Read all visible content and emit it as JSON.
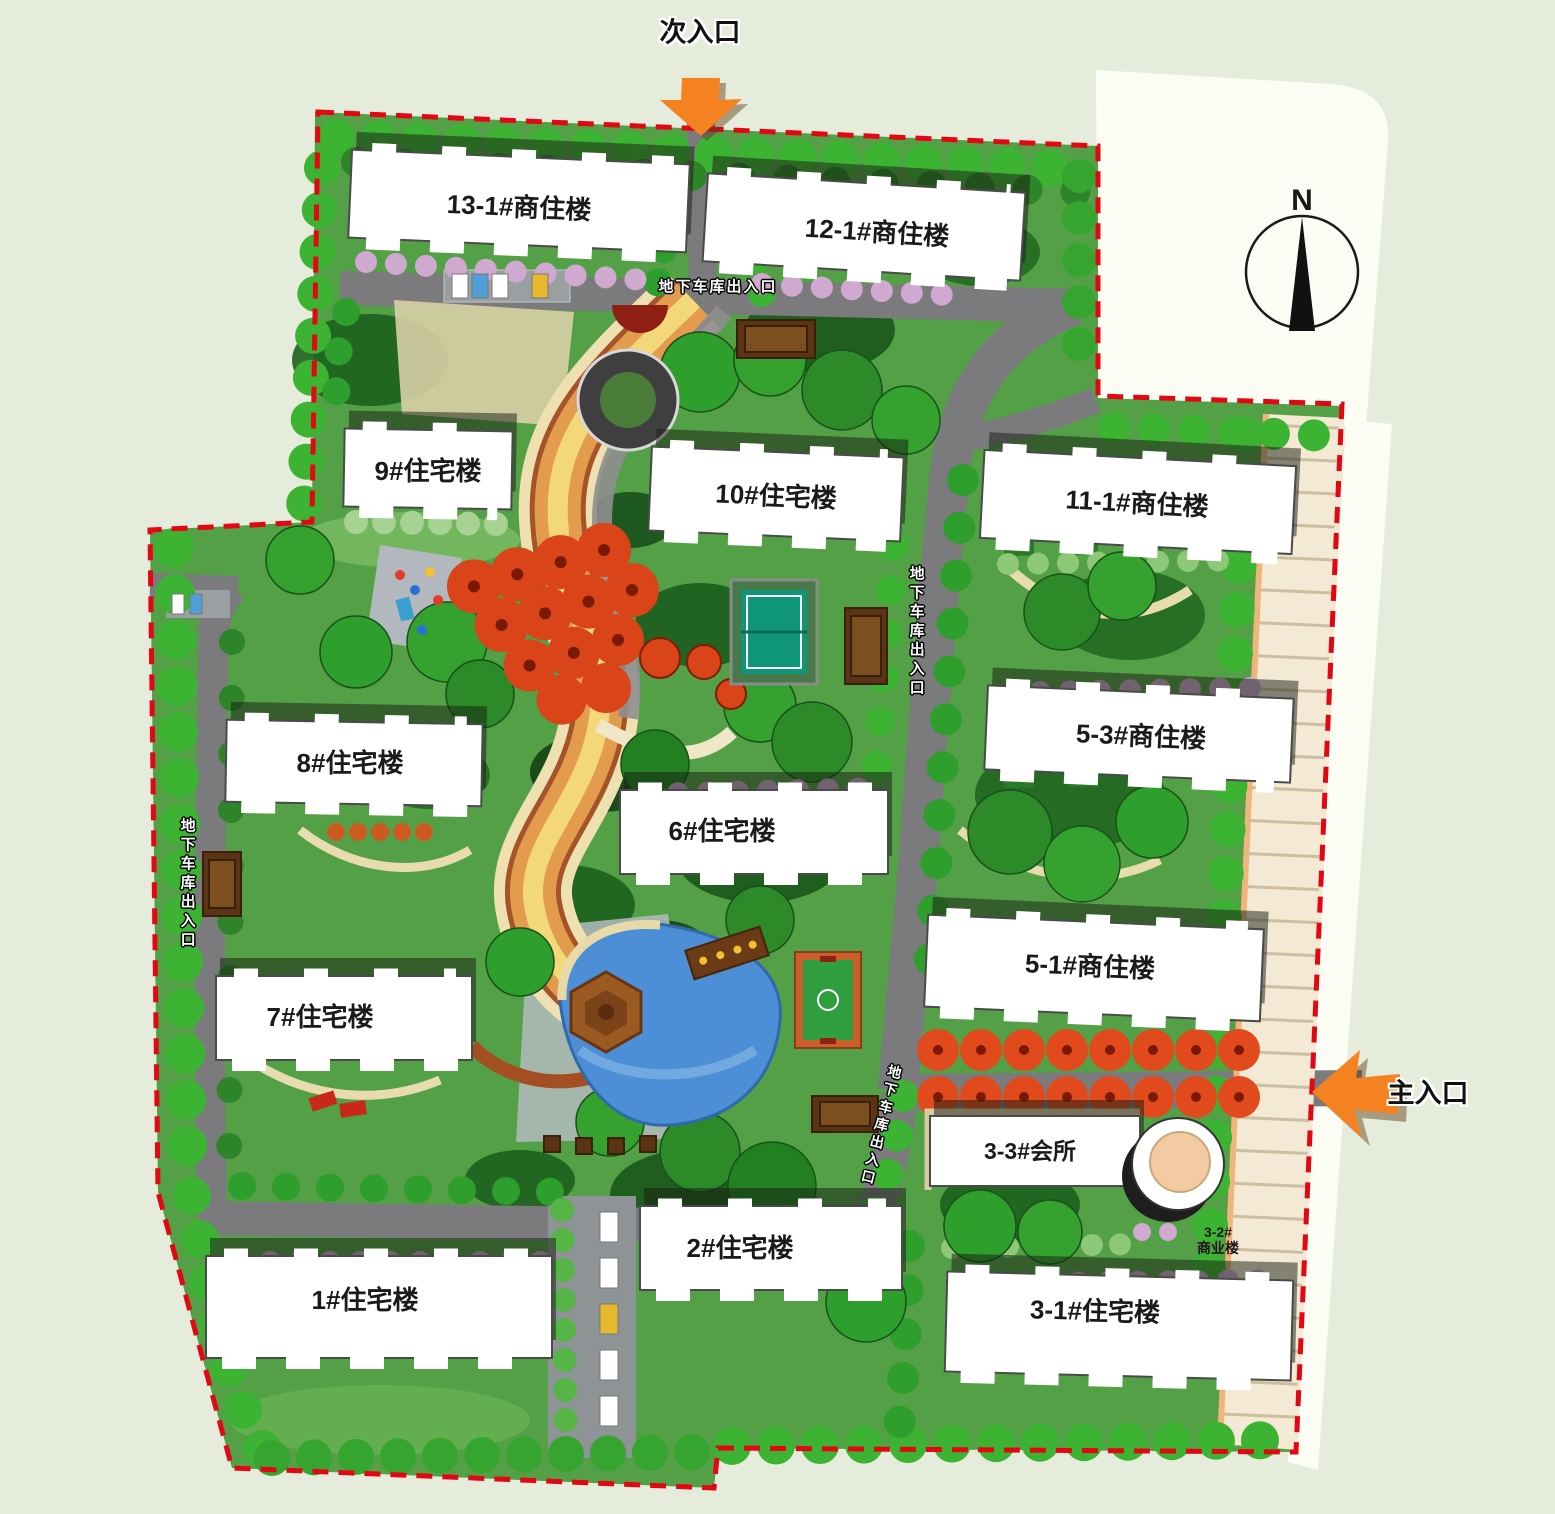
{
  "plan": {
    "entrances": {
      "secondary_label": "次入口",
      "main_label": "主入口"
    },
    "compass": {
      "north_label": "N"
    },
    "garage_label": "地下车库出入口",
    "buildings": [
      {
        "id": "13-1",
        "label": "13-1#商住楼"
      },
      {
        "id": "12-1",
        "label": "12-1#商住楼"
      },
      {
        "id": "9",
        "label": "9#住宅楼"
      },
      {
        "id": "10",
        "label": "10#住宅楼"
      },
      {
        "id": "11-1",
        "label": "11-1#商住楼"
      },
      {
        "id": "5-3",
        "label": "5-3#商住楼"
      },
      {
        "id": "8",
        "label": "8#住宅楼"
      },
      {
        "id": "6",
        "label": "6#住宅楼"
      },
      {
        "id": "5-1",
        "label": "5-1#商住楼"
      },
      {
        "id": "7",
        "label": "7#住宅楼"
      },
      {
        "id": "3-3",
        "label": "3-3#会所"
      },
      {
        "id": "3-2",
        "label_line1": "3-2#",
        "label_line2": "商业楼"
      },
      {
        "id": "2",
        "label": "2#住宅楼"
      },
      {
        "id": "1",
        "label": "1#住宅楼"
      },
      {
        "id": "3-1",
        "label": "3-1#住宅楼"
      }
    ],
    "colors": {
      "page_background": "#E6ECDC",
      "grass": "#54A046",
      "road": "#7B7B7D",
      "boundary_dash": "#E30613",
      "entrance_arrow": "#F58220",
      "water": "#4C8FD6",
      "building_fill": "#FFFFFF",
      "autumn_tree": "#DD4418",
      "blossom_tree": "#CFA9CF",
      "spine_path": "#E39B4D"
    }
  }
}
